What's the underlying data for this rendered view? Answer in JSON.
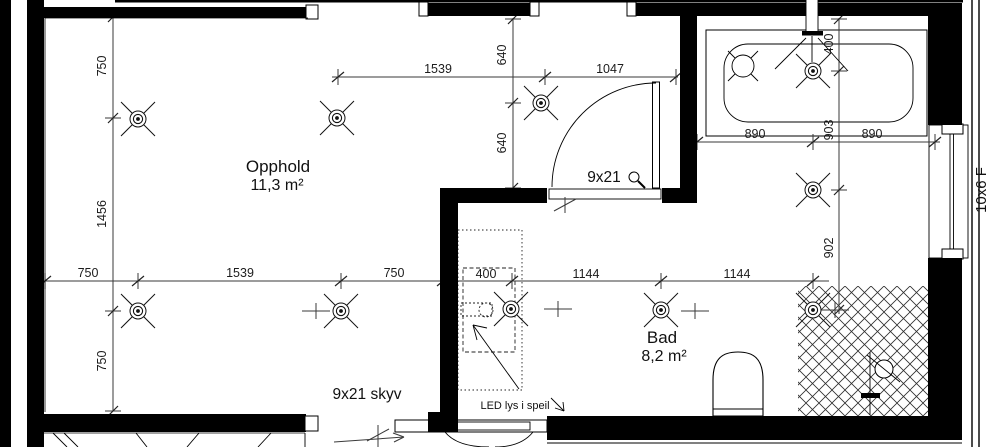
{
  "plan": {
    "rooms": {
      "opphold": {
        "name": "Opphold",
        "area": "11,3 m²"
      },
      "bad": {
        "name": "Bad",
        "area": "8,2 m²"
      }
    },
    "openings": {
      "swing_door_label": "9x21",
      "sliding_door_label": "9x21 skyv",
      "window_label": "10x6 F"
    },
    "annotations": {
      "mirror_note": "LED lys i speil"
    },
    "dimensions": {
      "left_vertical": [
        "750",
        "1456",
        "750"
      ],
      "main_horizontal": [
        "750",
        "1539",
        "750",
        "400",
        "1144",
        "1144"
      ],
      "top_horizontal": [
        "1539",
        "1047"
      ],
      "hall_vertical": [
        "640",
        "640"
      ],
      "bath_vertical": [
        "400",
        "903",
        "902"
      ],
      "bathtub_horizontal": [
        "890",
        "890"
      ]
    },
    "symbols": {
      "ceiling_light": "ceiling-light-symbol",
      "shower_head": "shower-head-symbol",
      "bathtub": "bathtub-symbol",
      "toilet": "toilet-symbol",
      "vanity_sink": "vanity-sink-symbol"
    },
    "colors": {
      "ink": "#000000",
      "dim_line": "#3a3a3a",
      "background": "#ffffff"
    }
  }
}
